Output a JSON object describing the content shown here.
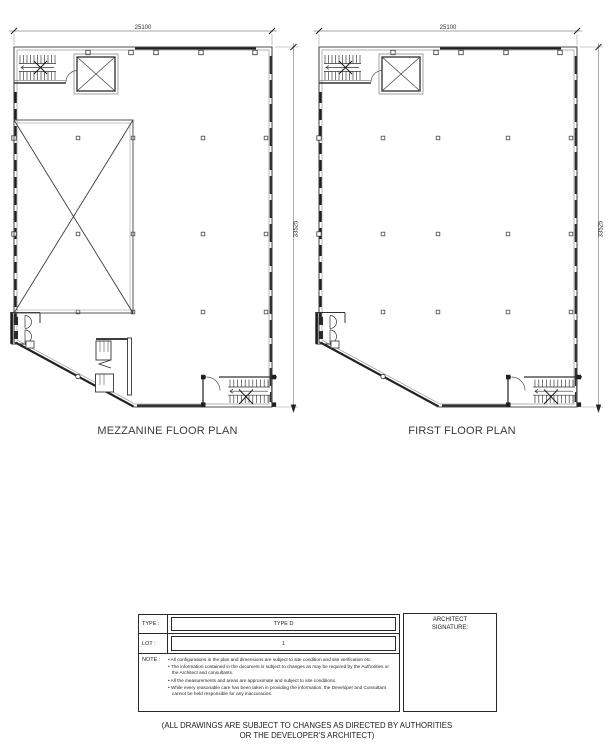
{
  "sheet": {
    "background": "#ffffff",
    "line_color": "#3f3f3f",
    "dim_color": "#888888",
    "text_color": "#2d2d2d"
  },
  "plans": [
    {
      "title": "MEZZANINE FLOOR PLAN",
      "top_dimension": "25100",
      "side_dimension": "33525"
    },
    {
      "title": "FIRST FLOOR PLAN",
      "top_dimension": "25100",
      "side_dimension": "33525"
    }
  ],
  "info_table": {
    "rows": [
      {
        "label": "TYPE :",
        "value": "TYPE D"
      },
      {
        "label": "LOT :",
        "value": "1"
      }
    ],
    "note_label": "NOTE :",
    "notes": [
      "All configurations in the plan and dimensions are subject to site condition and site verification etc.",
      "The information contained in the document is subject to changes as may be required by the Authorities or the Architect and consultants.",
      "All the measurements and areas are approximate and subject to site conditions.",
      "While every reasonable care has been taken in providing the information, the Developer and Consultant cannot be held responsible for any inaccuracies."
    ],
    "architect_label_line1": "ARCHITECT",
    "architect_label_line2": "SIGNATURE:"
  },
  "footer": {
    "line1": "(ALL DRAWINGS ARE SUBJECT TO CHANGES AS DIRECTED BY AUTHORITIES",
    "line2": "OR THE DEVELOPER'S ARCHITECT)"
  }
}
